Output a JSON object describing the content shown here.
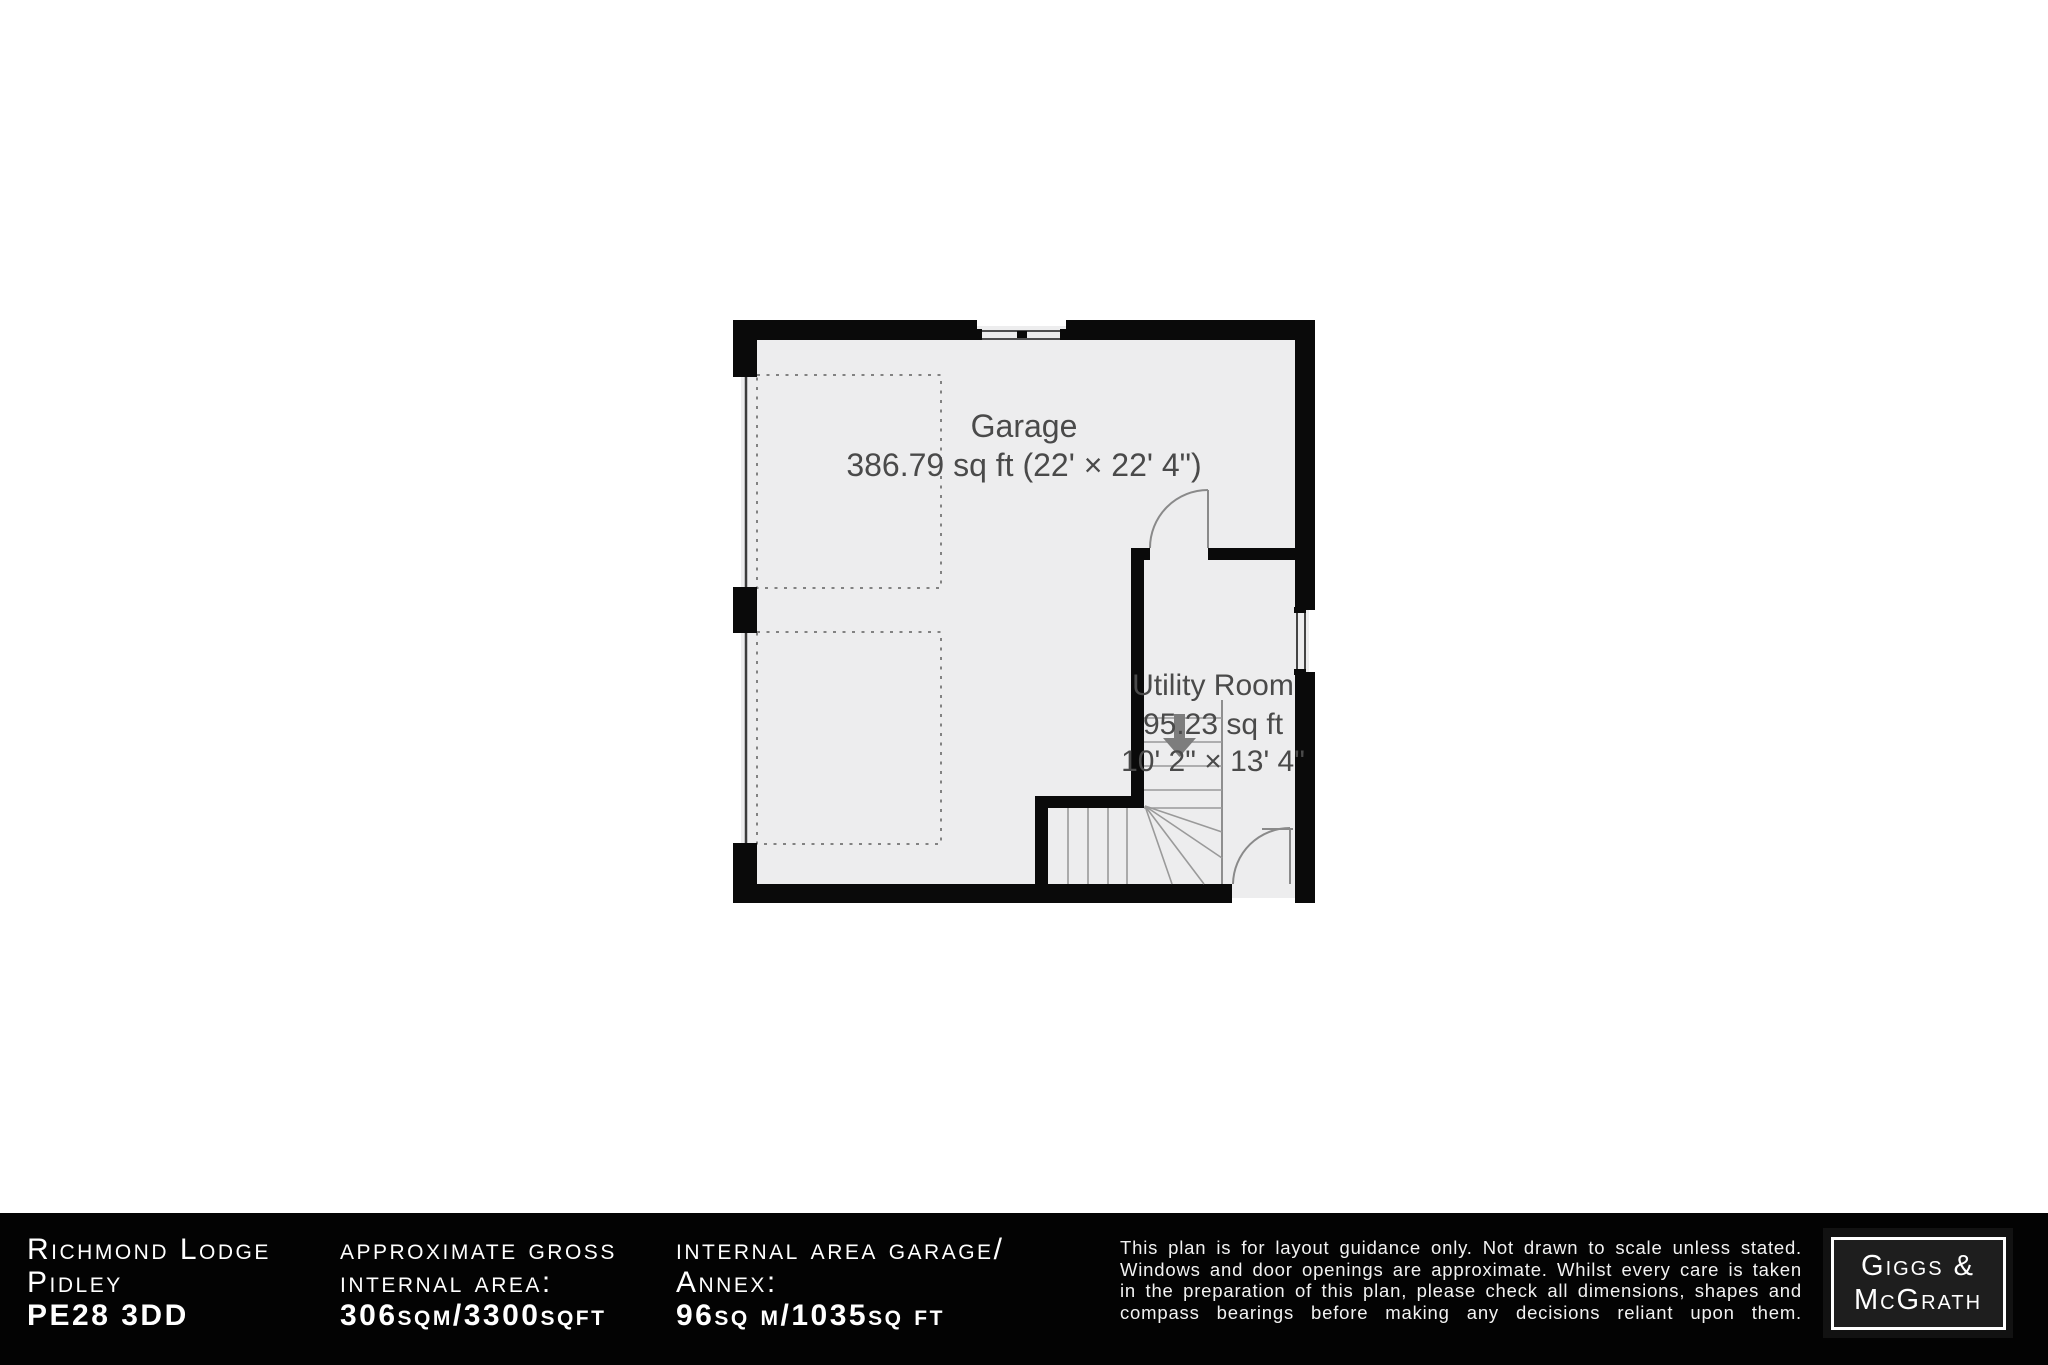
{
  "plan": {
    "garage": {
      "label": "Garage",
      "area": "386.79 sq ft (22' × 22' 4\")"
    },
    "utility": {
      "label": "Utility Room",
      "area": "95.23 sq ft",
      "dims": "10' 2\" × 13' 4\""
    }
  },
  "footer": {
    "address": {
      "line1": "Richmond Lodge",
      "line2": "Pidley",
      "line3": "PE28 3DD"
    },
    "gross_area": {
      "line1": "approximate gross",
      "line2": "internal area:",
      "line3": "306sqm/3300sqft"
    },
    "garage_area": {
      "line1": "internal area garage/",
      "line2": "Annex:",
      "line3": "96sq m/1035sq ft"
    },
    "disclaimer": "This plan is for layout guidance only. Not drawn to scale unless stated. Windows and door openings are approximate. Whilst every care is taken in the preparation of this plan, please check all dimensions, shapes and compass bearings before making any decisions reliant upon them.",
    "logo": {
      "line1": "Giggs &",
      "line2": "McGrath"
    }
  },
  "colors": {
    "wall": "#0a0a0a",
    "floor": "#ededee",
    "room_label": "#4a4a4a",
    "footer_bg": "#030303",
    "footer_text": "#ffffff",
    "stair_line": "#9a9a9a",
    "door_arc": "#8a8a8a",
    "dashed_zone": "#828282"
  }
}
